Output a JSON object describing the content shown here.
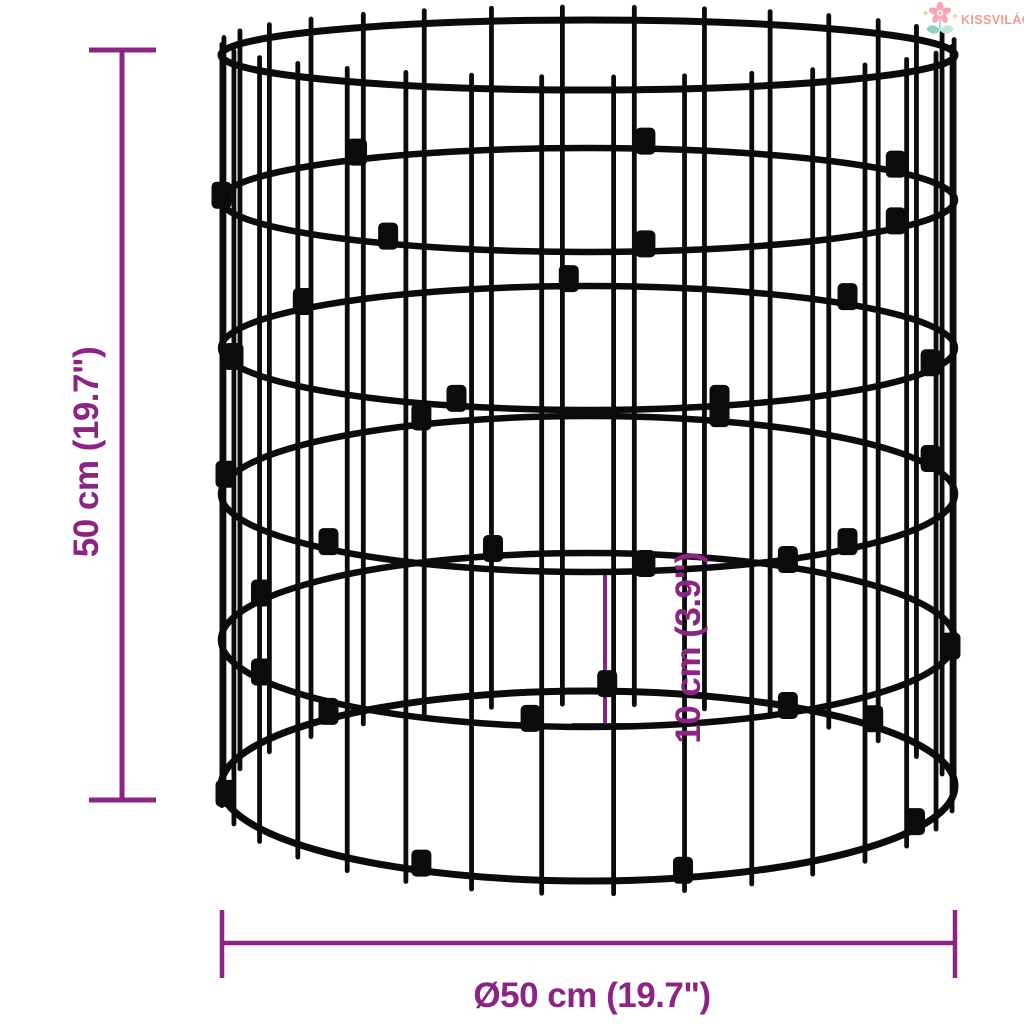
{
  "logo": {
    "text": "KISSVILÁG",
    "color": "#F09A90"
  },
  "dimensions": {
    "height_label": "50 cm (19.7\")",
    "diameter_label": "Ø50 cm (19.7\")",
    "mesh_label": "10 cm (3.9\")"
  },
  "colors": {
    "dimension": "#8C2483",
    "wire": "#0b0b0b",
    "petal": "#F5A7B7",
    "flower_center": "#FBE3E8",
    "flower_dot": "#F2A96B",
    "leaf_dark": "#8FD2BD",
    "leaf_light": "#C3E6DA",
    "sparkle": "#F6C18C"
  }
}
